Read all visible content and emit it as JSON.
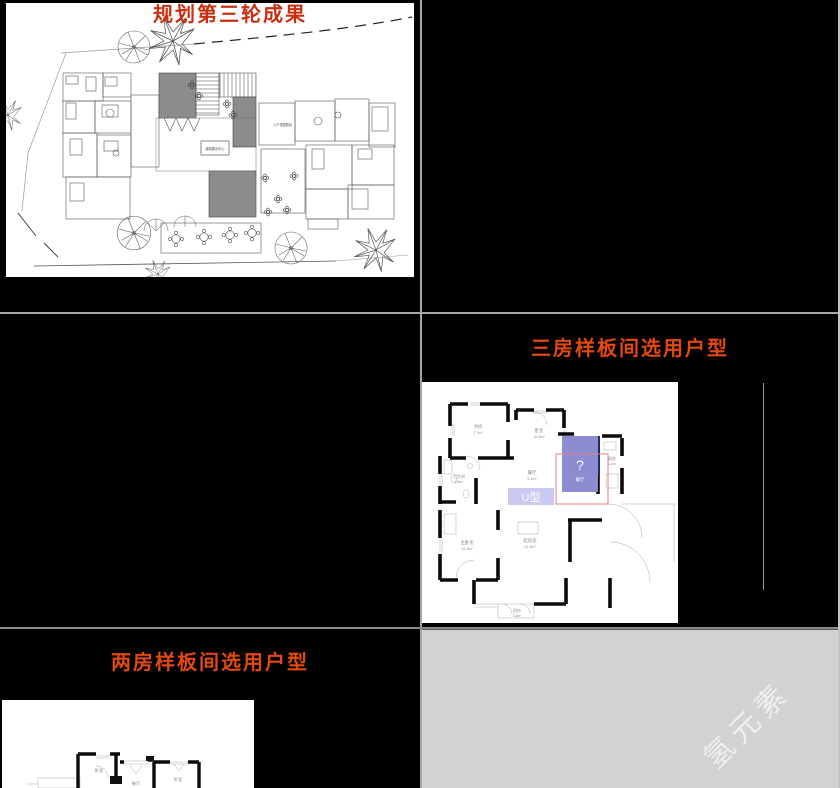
{
  "app": {
    "background_color": "#000000",
    "canvas_color": "#d2d2d2",
    "divider_color": "#a6a6a6",
    "watermark": {
      "text": "氢元素",
      "color": "rgba(255,255,255,0.65)"
    }
  },
  "slides": [
    {
      "id": "slide-1",
      "title": "规划第三轮成果",
      "title_color": "#c92f12",
      "site_plan_labels": {
        "entry_garden": "入户花园阳台",
        "center_hall": "建筑展示中心"
      }
    },
    {
      "id": "slide-2-blank",
      "title": ""
    },
    {
      "id": "slide-3-blank",
      "title": ""
    },
    {
      "id": "slide-4",
      "title": "三房样板间选用户型",
      "title_color": "#e2490e",
      "floorplan": {
        "highlight_question": "?",
        "highlight_label": "餐厅",
        "type_chip": "U型",
        "highlight_fill": "#8b8dd0",
        "chip_fill": "#c9c9f1",
        "outline_color": "#e08080",
        "rooms": [
          {
            "name": "书房",
            "area": "7.7m²"
          },
          {
            "name": "卧室",
            "area": "10.0m²"
          },
          {
            "name": "卫生间",
            "area": "4.0m²"
          },
          {
            "name": "餐厅",
            "area": "9.1m²"
          },
          {
            "name": "厨房",
            "area": "6.1m²"
          },
          {
            "name": "主卧室",
            "area": "12.3m²"
          },
          {
            "name": "起居室",
            "area": "21.3m²"
          },
          {
            "name": "阳台",
            "area": "3.2m²"
          }
        ]
      }
    },
    {
      "id": "slide-5",
      "title": "两房样板间选用户型",
      "title_color": "#e2490e",
      "floorplan": {
        "rooms": [
          {
            "name": "卧室"
          },
          {
            "name": "餐厅"
          },
          {
            "name": "卧室"
          }
        ]
      }
    }
  ]
}
